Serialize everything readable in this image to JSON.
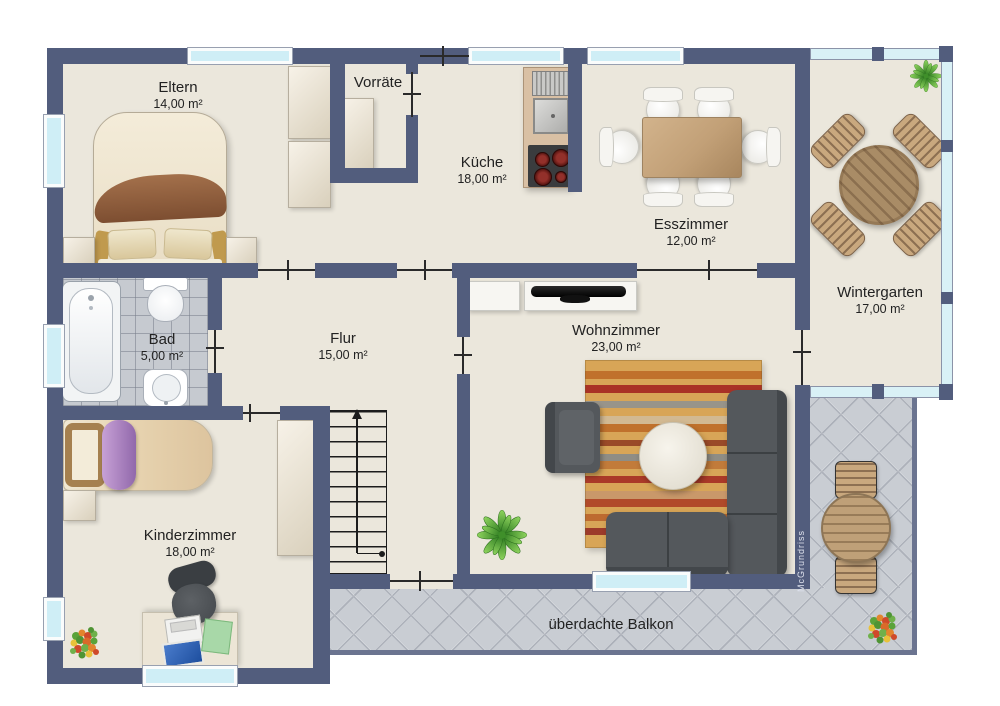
{
  "page": {
    "width": 1000,
    "height": 706,
    "background": "#ffffff"
  },
  "rooms": {
    "eltern": {
      "name": "Eltern",
      "area": "14,00 m²"
    },
    "vorraete": {
      "name": "Vorräte"
    },
    "kueche": {
      "name": "Küche",
      "area": "18,00 m²"
    },
    "esszimmer": {
      "name": "Esszimmer",
      "area": "12,00 m²"
    },
    "wintergarten": {
      "name": "Wintergarten",
      "area": "17,00 m²"
    },
    "bad": {
      "name": "Bad",
      "area": "5,00 m²"
    },
    "flur": {
      "name": "Flur",
      "area": "15,00 m²"
    },
    "wohnzimmer": {
      "name": "Wohnzimmer",
      "area": "23,00 m²"
    },
    "kinderzimmer": {
      "name": "Kinderzimmer",
      "area": "18,00 m²"
    },
    "balkon": {
      "name": "überdachte Balkon"
    }
  },
  "watermark": "McGrundriss",
  "colors": {
    "wall": "#525d7d",
    "floor": "#ebe7dc",
    "window_glass": "#cfeef6",
    "window_frame": "#fafcfc",
    "wintergarten_glass": "#d9f1f6",
    "bath_tile": "#c6cad0",
    "balcony_tile": "#c9cdd3",
    "balcony_border": "#6b7490",
    "sofa": "#53575b",
    "wood": "#c2a57e",
    "rug_base": "#d8a557",
    "stair_line": "#1c1c1c",
    "label_text": "#222222"
  },
  "furniture": {
    "eltern": [
      "double-bed",
      "nightstand",
      "nightstand",
      "wardrobe",
      "wardrobe"
    ],
    "vorraete": [
      "shelf"
    ],
    "kueche": [
      "sink-drainer",
      "sink",
      "stove"
    ],
    "esszimmer": [
      "dining-table",
      "chair",
      "chair",
      "chair",
      "chair",
      "chair",
      "chair"
    ],
    "wintergarten": [
      "round-table",
      "chair",
      "chair",
      "chair",
      "chair",
      "plant"
    ],
    "bad": [
      "bathtub",
      "toilet",
      "sink"
    ],
    "flur": [
      "staircase"
    ],
    "wohnzimmer": [
      "sideboard",
      "tv-board",
      "tv",
      "rug",
      "armchair",
      "corner-sofa",
      "coffee-table",
      "plant"
    ],
    "kinderzimmer": [
      "bed",
      "nightstand",
      "wardrobe",
      "desk",
      "office-chair",
      "laptop",
      "toys"
    ],
    "balkon": [
      "round-table",
      "chair",
      "chair",
      "flowers"
    ]
  }
}
